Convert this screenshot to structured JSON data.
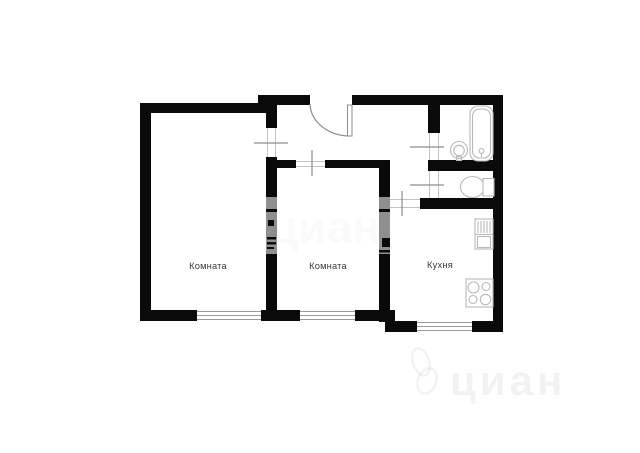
{
  "plan": {
    "type": "apartment-floor-plan",
    "labels": {
      "room1": "Комната",
      "room2": "Комната",
      "kitchen": "Кухня"
    },
    "watermark": {
      "text": "циан"
    },
    "colors": {
      "background": "#ffffff",
      "wall": "#0a0a0a",
      "door_leaf": "#8c8c8c",
      "fixture_stroke": "#b8b8b8",
      "label_text": "#3a3a3a",
      "watermark_on_wall": "#8f8f8f"
    }
  }
}
